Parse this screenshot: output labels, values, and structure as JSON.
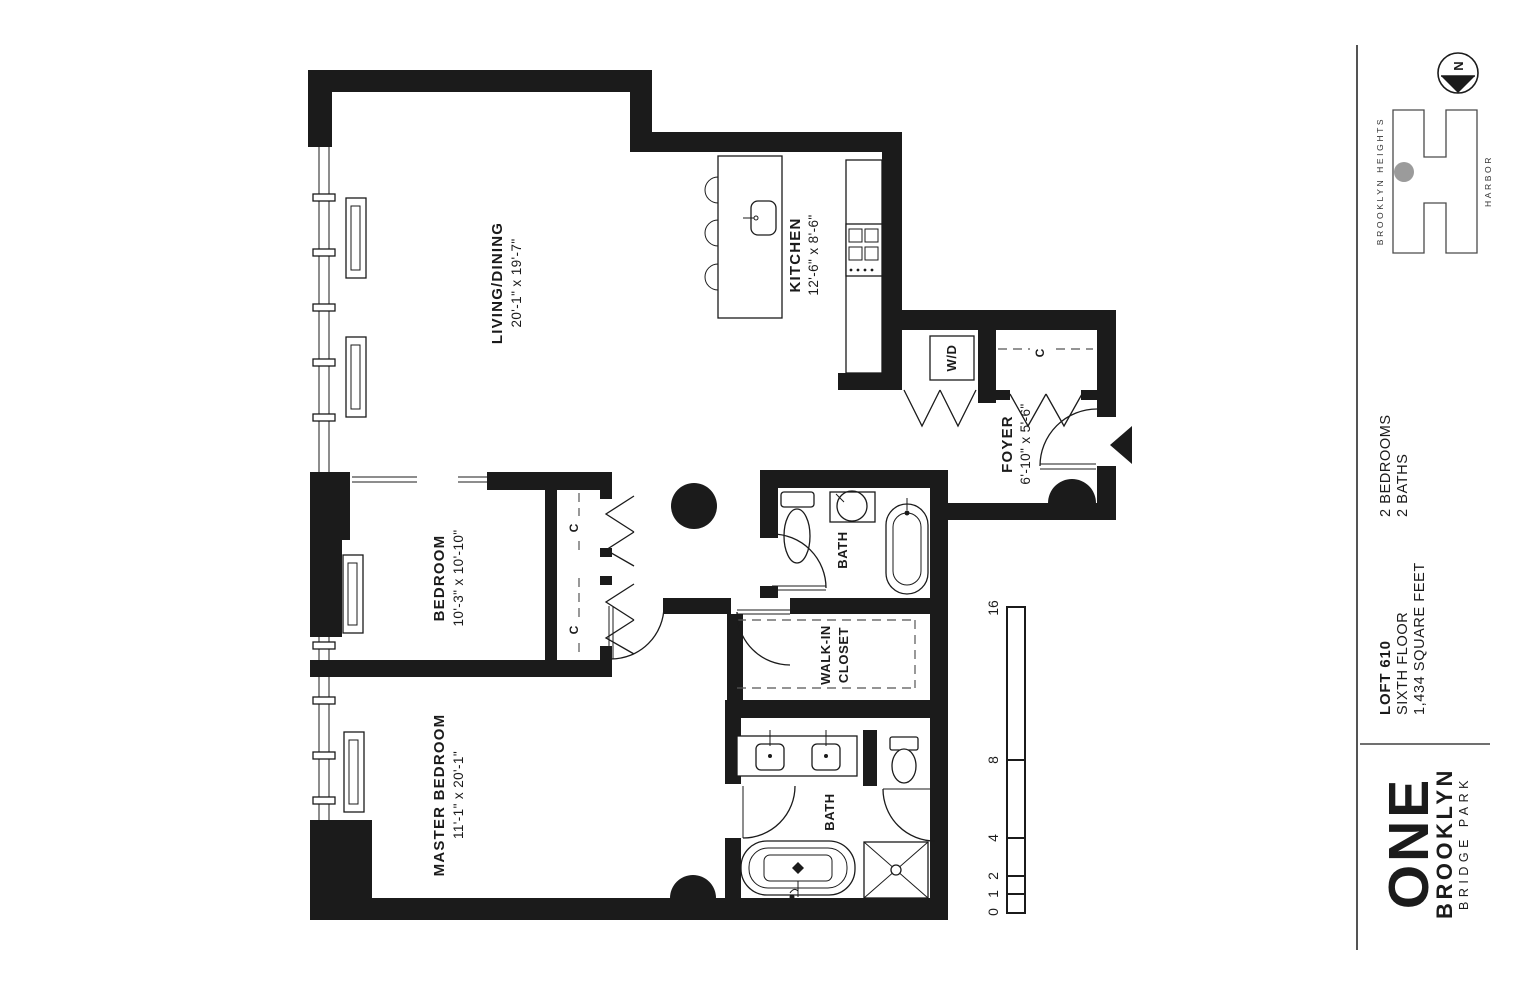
{
  "plan": {
    "rooms": {
      "living": {
        "name": "LIVING/DINING",
        "dims": "20'-1\" x 19'-7\""
      },
      "kitchen": {
        "name": "KITCHEN",
        "dims": "12'-6\" x 8'-6\""
      },
      "foyer": {
        "name": "FOYER",
        "dims": "6'-10\" x 5'-6\""
      },
      "bedroom": {
        "name": "BEDROOM",
        "dims": "10'-3\" x 10'-10\""
      },
      "master_bedroom": {
        "name": "MASTER BEDROOM",
        "dims": "11'-1\" x 20'-1\""
      },
      "bath_upper": {
        "name": "BATH"
      },
      "bath_master": {
        "name": "BATH"
      },
      "walk_in_closet": {
        "line1": "WALK-IN",
        "line2": "CLOSET"
      },
      "closet_abbr": "C",
      "washer_dryer": "W/D"
    },
    "scale_bar": {
      "labels": [
        "0",
        "1",
        "2",
        "4",
        "8",
        "16"
      ]
    },
    "compass": {
      "letter": "N"
    }
  },
  "panel": {
    "building_logo": {
      "left_text": "BROOKLYN HEIGHTS",
      "right_text": "HARBOR"
    },
    "unit": {
      "bedrooms": "2 BEDROOMS",
      "baths": "2 BATHS",
      "name": "LOFT 610",
      "floor": "SIXTH FLOOR",
      "area": "1,434 SQUARE FEET"
    },
    "brand": {
      "line1": "ONE",
      "line2": "BROOKLYN",
      "line3": "BRIDGE PARK"
    }
  },
  "colors": {
    "wall": "#1b1b1b",
    "accent_dot": "#9b9b9b"
  }
}
